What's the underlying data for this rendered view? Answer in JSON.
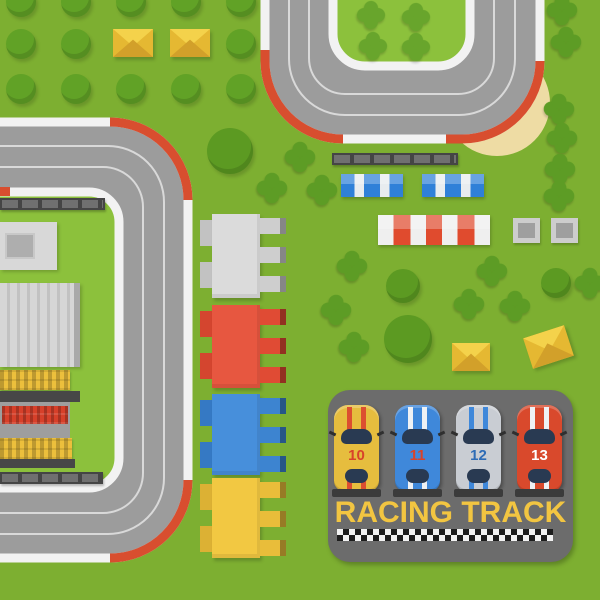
{
  "title": {
    "text": "RACING TRACK",
    "color": "#f2c541"
  },
  "cars": [
    {
      "number": "10",
      "body": "#e6bd3e",
      "stripes": "#dc4f30",
      "number_color": "#d8432a"
    },
    {
      "number": "11",
      "body": "#3f88da",
      "stripes": "#eef1f4",
      "number_color": "#d8432a"
    },
    {
      "number": "12",
      "body": "#c9cdd3",
      "stripes": "#3f88da",
      "number_color": "#2e6cb6"
    },
    {
      "number": "13",
      "body": "#d9492c",
      "stripes": "#eef1f4",
      "number_color": "#ffffff"
    }
  ],
  "palette": {
    "grass": "#7daf31",
    "infield_grass": "#8cc13c",
    "road": "#9c9c9c",
    "road_edge": "#f2f2f2",
    "curb_red": "#d84e2f",
    "sand": "#eedca4",
    "panel_gray": "#6c6c6c",
    "title_yellow": "#f2c541",
    "tree_green": "#5f9e25"
  },
  "scenery": {
    "round_trees": [
      [
        21,
        2,
        15
      ],
      [
        76,
        2,
        15
      ],
      [
        131,
        2,
        15
      ],
      [
        186,
        2,
        15
      ],
      [
        241,
        2,
        15
      ],
      [
        21,
        44,
        15
      ],
      [
        76,
        44,
        15
      ],
      [
        241,
        44,
        15
      ],
      [
        21,
        89,
        15
      ],
      [
        76,
        89,
        15
      ],
      [
        131,
        89,
        15
      ],
      [
        186,
        89,
        15
      ],
      [
        241,
        89,
        15
      ],
      [
        230,
        151,
        23,
        1
      ],
      [
        403,
        286,
        17,
        1
      ],
      [
        408,
        339,
        24,
        1
      ],
      [
        556,
        283,
        15,
        1
      ]
    ],
    "bushes": [
      [
        300,
        157
      ],
      [
        272,
        188
      ],
      [
        322,
        190
      ],
      [
        352,
        266
      ],
      [
        336,
        310
      ],
      [
        354,
        347
      ],
      [
        492,
        271
      ],
      [
        469,
        304
      ],
      [
        515,
        306
      ],
      [
        590,
        283
      ],
      [
        562,
        10
      ],
      [
        566,
        42
      ],
      [
        559,
        109
      ],
      [
        562,
        138
      ],
      [
        560,
        169
      ],
      [
        559,
        196
      ]
    ],
    "infield_bushes": [
      [
        371,
        15
      ],
      [
        416,
        17
      ],
      [
        373,
        46
      ],
      [
        416,
        47
      ]
    ]
  }
}
